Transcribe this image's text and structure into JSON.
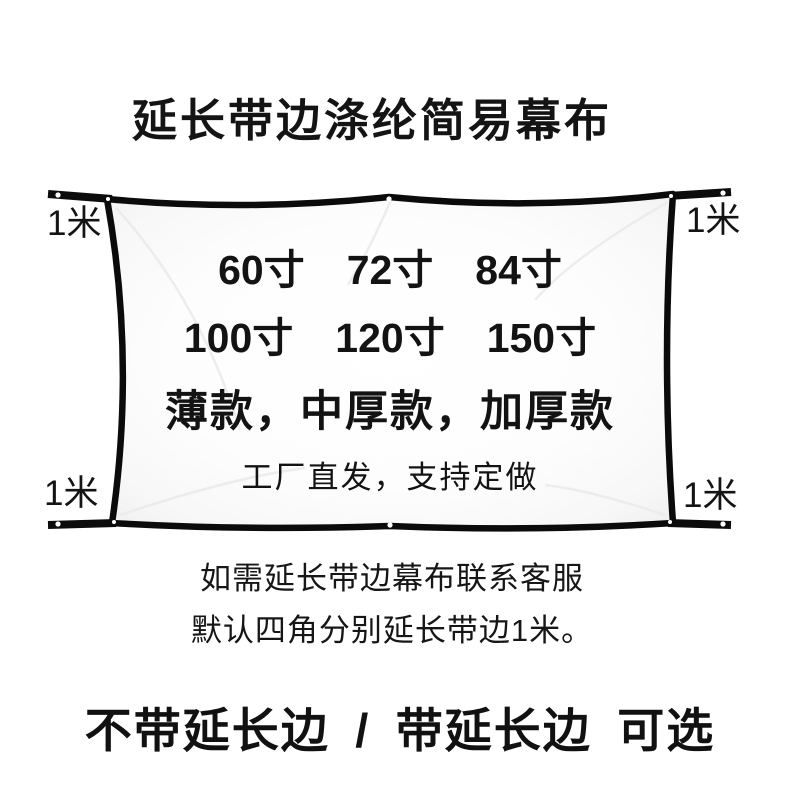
{
  "title": "延长带边涤纶简易幕布",
  "screen": {
    "sizes": [
      "60寸",
      "72寸",
      "84寸",
      "100寸",
      "120寸",
      "150寸"
    ],
    "thickness_line": "薄款，中厚款，加厚款",
    "factory_line": "工厂直发，支持定做",
    "corner_extension_label": "1米",
    "colors": {
      "border": "#0b0b0b",
      "fabric": "#fcfcfc",
      "page_background": "#ffffff",
      "text": "#161616"
    }
  },
  "notes": [
    "如需延长带边幕布联系客服",
    "默认四角分别延长带边1米。"
  ],
  "footer": {
    "options_line": "不带延长边 / 带延长边 可选"
  }
}
